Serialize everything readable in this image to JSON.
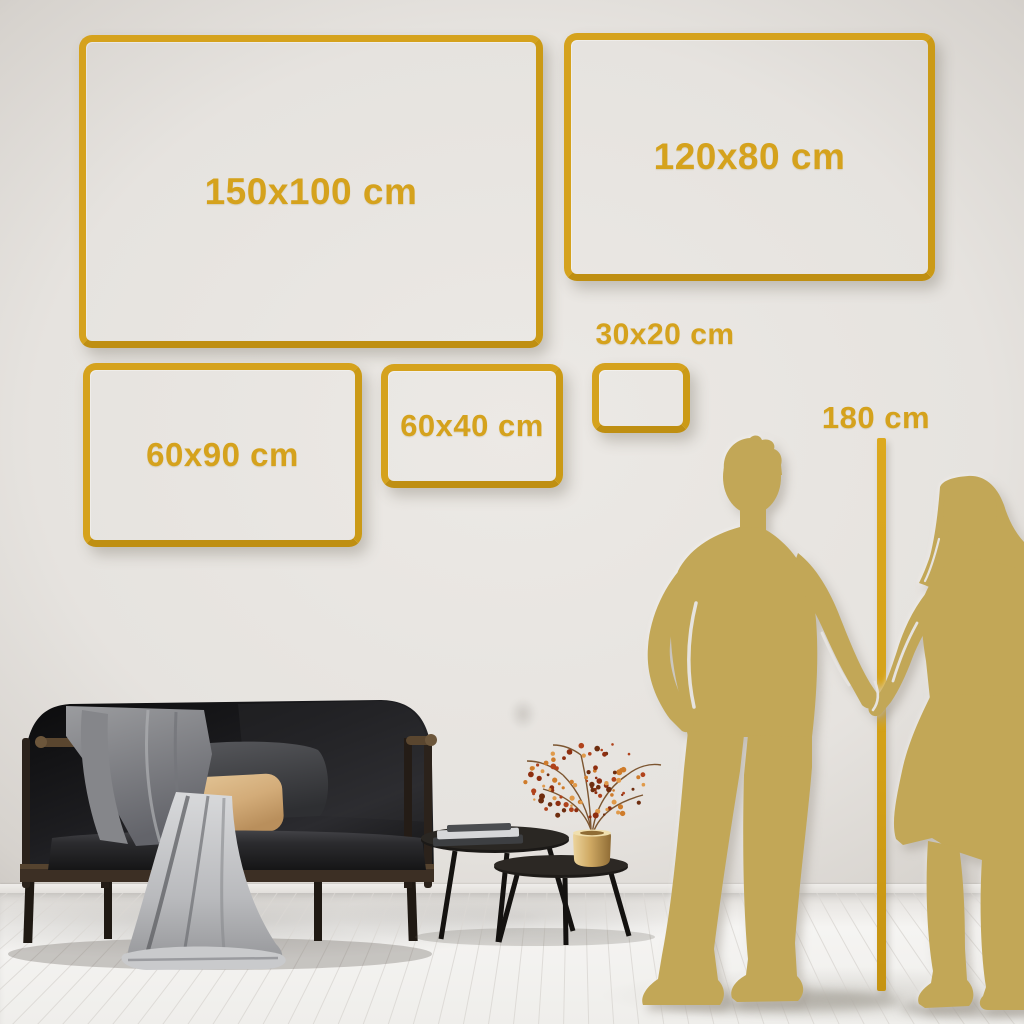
{
  "size_guide": {
    "size_frames": [
      {
        "name": "150x100",
        "label": "150x100 cm",
        "width_cm": 150,
        "height_cm": 100
      },
      {
        "name": "120x80",
        "label": "120x80 cm",
        "width_cm": 120,
        "height_cm": 80
      },
      {
        "name": "60x90",
        "label": "60x90 cm",
        "width_cm": 60,
        "height_cm": 90
      },
      {
        "name": "60x40",
        "label": "60x40 cm",
        "width_cm": 60,
        "height_cm": 40
      },
      {
        "name": "30x20",
        "label": "30x20 cm",
        "width_cm": 30,
        "height_cm": 20
      }
    ],
    "height_marker": {
      "label": "180 cm",
      "height_cm": 180
    }
  },
  "colors": {
    "frame_gold": "#D5A21D",
    "silhouette_gold": "#C2A757",
    "height_line_gold": "#D2A017",
    "wall": "#E6E3DF",
    "floor": "#F3F1EE"
  }
}
